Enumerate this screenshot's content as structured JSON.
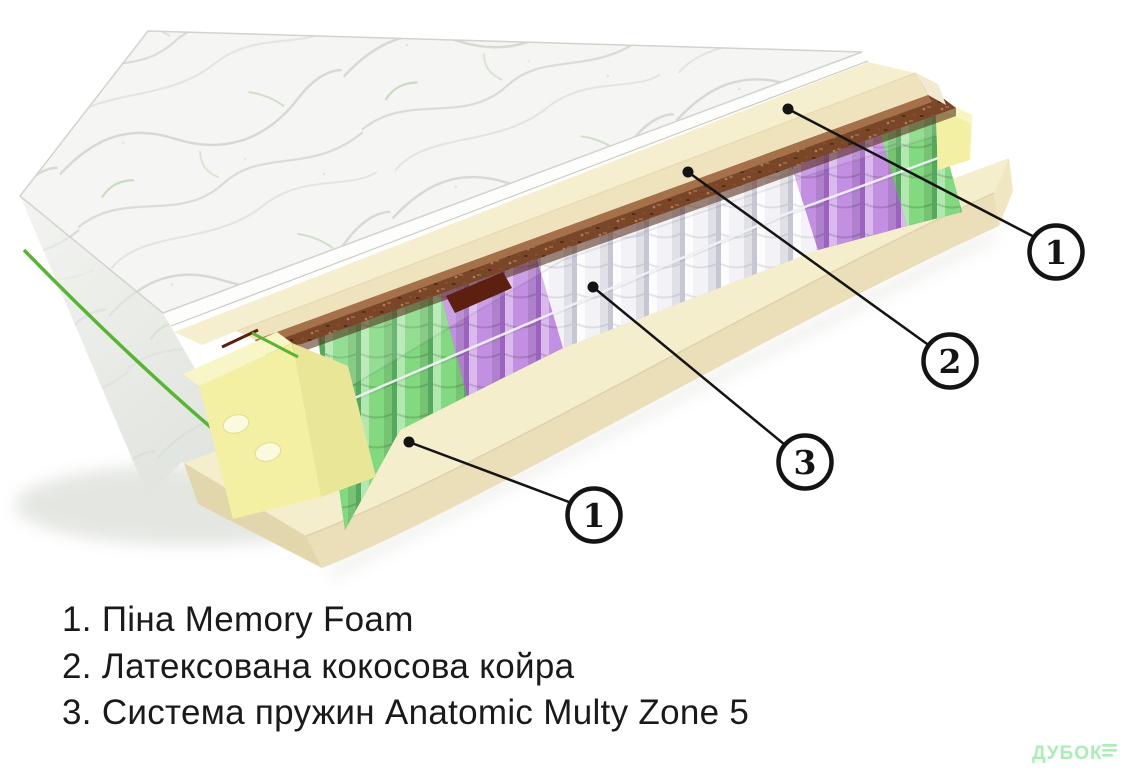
{
  "page": {
    "background": "#ffffff"
  },
  "illustration": {
    "type": "mattress-layers-cutaway",
    "callouts": [
      {
        "number": "1",
        "target": "memory-foam-top-layer"
      },
      {
        "number": "2",
        "target": "coconut-coir-layer"
      },
      {
        "number": "3",
        "target": "spring-system"
      },
      {
        "number": "1",
        "target": "foam-base-layer"
      }
    ],
    "spring_zone_order": [
      "green",
      "purple",
      "white",
      "purple",
      "green"
    ],
    "colors": {
      "foam_top": "#f5eecd",
      "foam_front": "#eadfb8",
      "foam_side": "#e2d7ac",
      "slab_top": "#f6efcf",
      "slab_front": "#eee3bd",
      "coir": "#7a4629",
      "coir_dark": "#4c2310",
      "coir_light": "#a5714a",
      "corner_foam": "#f3f0a4",
      "corner_top": "#f8f6c6",
      "corner_side": "#e9e697",
      "spring_green": "#82d980",
      "spring_green_shade": "#55a95c",
      "spring_purple": "#c38fe2",
      "spring_purple_shade": "#9b63bf",
      "spring_white": "#f3f3f7",
      "spring_white_shade": "#c6c6d4",
      "fabric": "#f5f6f3",
      "cut_fabric": "#fdfdfb",
      "quilt_line": "#d6d9d3",
      "leaf": "#bfd6b4",
      "piping": "#58b531",
      "accent_red": "#5c1f10",
      "callout_ink": "#141414"
    }
  },
  "legend": {
    "items": [
      "1. Піна Memory Foam",
      "2. Латексована кокосова койра",
      "3. Система пружин Anatomic Multy Zone 5"
    ]
  },
  "watermark": {
    "text": "ДУБОК",
    "color": "#a9efb4"
  }
}
